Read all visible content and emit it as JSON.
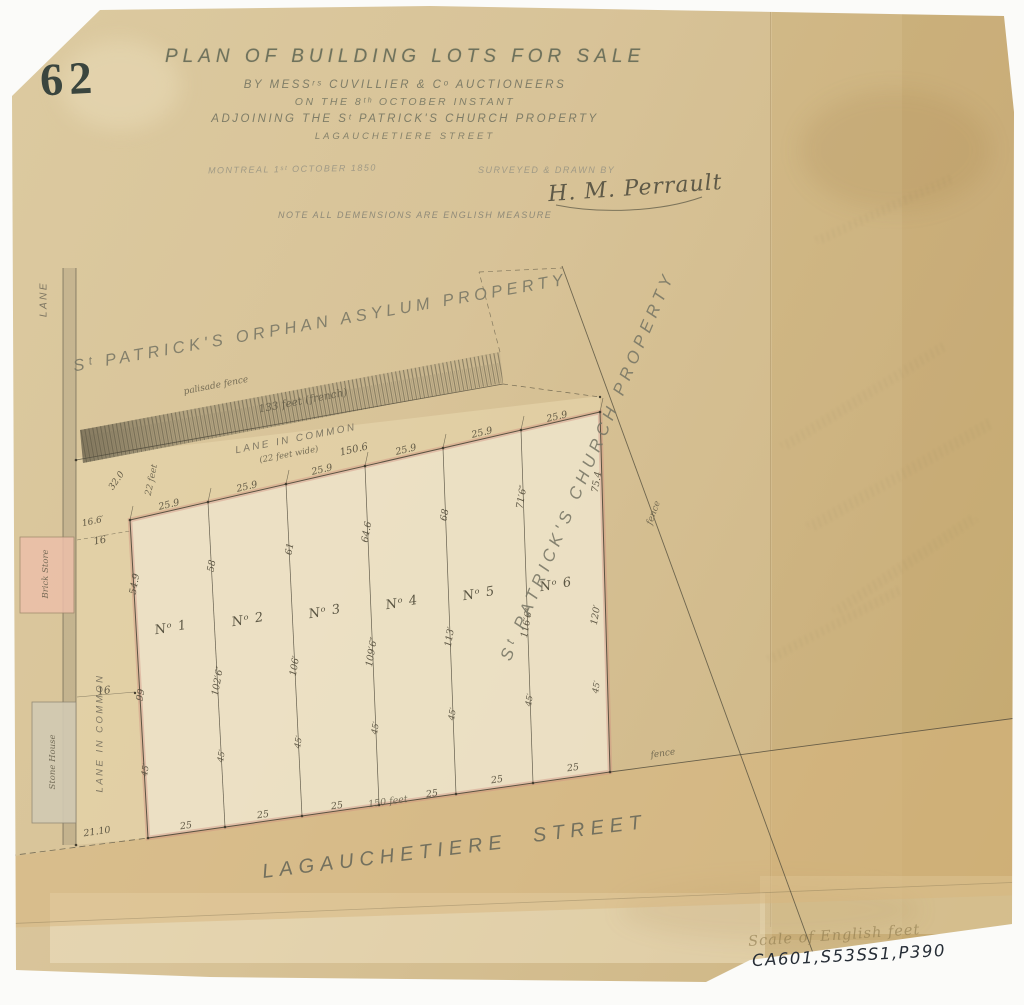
{
  "page_number": "62",
  "title_block": {
    "line1": "PLAN OF BUILDING LOTS FOR SALE",
    "line2": "BY MESSʳˢ CUVILLIER & Cᵒ AUCTIONEERS",
    "line3": "ON THE 8ᵗʰ OCTOBER INSTANT",
    "line4": "ADJOINING THE Sᵗ PATRICK'S CHURCH PROPERTY",
    "line5": "LAGAUCHETIERE STREET",
    "dateline": "MONTREAL 1ˢᵗ OCTOBER 1850",
    "surveyed_label": "SURVEYED & DRAWN BY",
    "signature": "H. M. Perrault",
    "note": "NOTE ALL DEMENSIONS ARE ENGLISH MEASURE"
  },
  "property_labels": {
    "asylum": "Sᵗ PATRICK'S ORPHAN ASYLUM PROPERTY",
    "church": "Sᵗ PATRICK'S CHURCH PROPERTY",
    "street_name": "LAGAUCHETIERE",
    "street_word": "STREET"
  },
  "archive": {
    "scale_note": "Scale of English feet",
    "reference": "CA601,S53SS1,P390"
  },
  "colors": {
    "paper": "#d6c195",
    "ink": "#4d4839",
    "faded_ink": "#7e8270",
    "boundary_pink": "#d08d7c",
    "lot_fill": "#eee4c9",
    "lane_fill": "#e7d7ae",
    "street_fill": "#d7b67e",
    "brick_fill": "#ecbfa9",
    "stone_fill": "#d2cab3"
  },
  "annotations": [
    {
      "t": "25.9",
      "x": 169,
      "y": 505,
      "r": -13,
      "n": "frontage-dim"
    },
    {
      "t": "25.9",
      "x": 247,
      "y": 487,
      "r": -13,
      "n": "frontage-dim"
    },
    {
      "t": "25.9",
      "x": 322,
      "y": 470,
      "r": -13,
      "n": "frontage-dim"
    },
    {
      "t": "150.6",
      "x": 354,
      "y": 450,
      "r": -13,
      "s": 10,
      "n": "total-top-dim"
    },
    {
      "t": "25.9",
      "x": 406,
      "y": 450,
      "r": -13,
      "n": "frontage-dim"
    },
    {
      "t": "25.9",
      "x": 482,
      "y": 433,
      "r": -13,
      "n": "frontage-dim"
    },
    {
      "t": "25.9",
      "x": 557,
      "y": 417,
      "r": -13,
      "n": "frontage-dim"
    },
    {
      "t": "palisade fence",
      "x": 216,
      "y": 386,
      "r": -11,
      "s": 9,
      "c": "script",
      "n": "palisade-fence-label"
    },
    {
      "t": "133 feet (french)",
      "x": 303,
      "y": 401,
      "r": -11,
      "s": 10.5,
      "c": "script",
      "n": "french-feet-label"
    },
    {
      "t": "LANE IN COMMON",
      "x": 296,
      "y": 439,
      "r": -11,
      "s": 10,
      "c": "caps",
      "n": "lane-in-common-label"
    },
    {
      "t": "(22 feet wide)",
      "x": 289,
      "y": 455,
      "r": -11,
      "s": 8.5,
      "c": "script",
      "n": "lane-width-label"
    },
    {
      "t": "LANE",
      "x": 44,
      "y": 299,
      "r": -90,
      "s": 10,
      "c": "caps",
      "n": "lane-label"
    },
    {
      "t": "22 feet",
      "x": 152,
      "y": 480,
      "r": -78,
      "s": 9,
      "c": "script",
      "n": "dim-label"
    },
    {
      "t": "32.0",
      "x": 117,
      "y": 481,
      "r": -55,
      "s": 9,
      "n": "dim-label"
    },
    {
      "t": "16.6′",
      "x": 93,
      "y": 522,
      "r": -12,
      "s": 9,
      "n": "dim-label"
    },
    {
      "t": "16",
      "x": 100,
      "y": 541,
      "r": -10,
      "s": 10,
      "n": "dim-label"
    },
    {
      "t": "16",
      "x": 104,
      "y": 691,
      "r": -8,
      "s": 10.5,
      "n": "dim-label"
    },
    {
      "t": "LANE IN COMMON",
      "x": 100,
      "y": 733,
      "r": -90,
      "s": 9.5,
      "c": "caps",
      "n": "lane-in-common-side-label"
    },
    {
      "t": "Brick Store",
      "x": 46,
      "y": 574,
      "r": -90,
      "s": 8.5,
      "c": "script",
      "n": "brick-store-label"
    },
    {
      "t": "Stone House",
      "x": 53,
      "y": 762,
      "r": -90,
      "s": 8.5,
      "c": "script",
      "n": "stone-house-label"
    },
    {
      "t": "54.9",
      "x": 135,
      "y": 584,
      "r": -80,
      "n": "depth-dim"
    },
    {
      "t": "58",
      "x": 212,
      "y": 566,
      "r": -80,
      "n": "depth-dim"
    },
    {
      "t": "61",
      "x": 290,
      "y": 549,
      "r": -80,
      "n": "depth-dim"
    },
    {
      "t": "64.6",
      "x": 367,
      "y": 532,
      "r": -80,
      "n": "depth-dim"
    },
    {
      "t": "68",
      "x": 445,
      "y": 515,
      "r": -80,
      "n": "depth-dim"
    },
    {
      "t": "71′6″",
      "x": 522,
      "y": 497,
      "r": -80,
      "n": "depth-dim"
    },
    {
      "t": "75.4",
      "x": 597,
      "y": 482,
      "r": -80,
      "n": "depth-dim"
    },
    {
      "t": "99",
      "x": 141,
      "y": 695,
      "r": -80,
      "n": "depth-dim"
    },
    {
      "t": "102′6″",
      "x": 218,
      "y": 681,
      "r": -80,
      "n": "depth-dim"
    },
    {
      "t": "106′",
      "x": 295,
      "y": 666,
      "r": -80,
      "n": "depth-dim"
    },
    {
      "t": "109′6″",
      "x": 372,
      "y": 652,
      "r": -80,
      "n": "depth-dim"
    },
    {
      "t": "113′",
      "x": 450,
      "y": 637,
      "r": -80,
      "n": "depth-dim"
    },
    {
      "t": "116′6″",
      "x": 527,
      "y": 623,
      "r": -80,
      "n": "depth-dim"
    },
    {
      "t": "120′",
      "x": 596,
      "y": 615,
      "r": -80,
      "n": "depth-dim"
    },
    {
      "t": "45′",
      "x": 146,
      "y": 770,
      "r": -80,
      "s": 8.5,
      "n": "depth-dim"
    },
    {
      "t": "45′",
      "x": 222,
      "y": 756,
      "r": -80,
      "s": 8.5,
      "n": "depth-dim"
    },
    {
      "t": "45′",
      "x": 299,
      "y": 742,
      "r": -80,
      "s": 8.5,
      "n": "depth-dim"
    },
    {
      "t": "45′",
      "x": 376,
      "y": 728,
      "r": -80,
      "s": 8.5,
      "n": "depth-dim"
    },
    {
      "t": "45′",
      "x": 453,
      "y": 714,
      "r": -80,
      "s": 8.5,
      "n": "depth-dim"
    },
    {
      "t": "45′",
      "x": 530,
      "y": 700,
      "r": -80,
      "s": 8.5,
      "n": "depth-dim"
    },
    {
      "t": "45′",
      "x": 597,
      "y": 687,
      "r": -80,
      "s": 8.5,
      "n": "depth-dim"
    },
    {
      "t": "Nᵒ 1",
      "x": 171,
      "y": 628,
      "r": -10,
      "s": 13,
      "c": "lot",
      "n": "lot-number-1"
    },
    {
      "t": "Nᵒ 2",
      "x": 248,
      "y": 620,
      "r": -10,
      "s": 13,
      "c": "lot",
      "n": "lot-number-2"
    },
    {
      "t": "Nᵒ 3",
      "x": 325,
      "y": 612,
      "r": -10,
      "s": 13,
      "c": "lot",
      "n": "lot-number-3"
    },
    {
      "t": "Nᵒ 4",
      "x": 402,
      "y": 603,
      "r": -10,
      "s": 13,
      "c": "lot",
      "n": "lot-number-4"
    },
    {
      "t": "Nᵒ 5",
      "x": 479,
      "y": 594,
      "r": -10,
      "s": 13,
      "c": "lot",
      "n": "lot-number-5"
    },
    {
      "t": "Nᵒ 6",
      "x": 556,
      "y": 585,
      "r": -10,
      "s": 13,
      "c": "lot",
      "n": "lot-number-6"
    },
    {
      "t": "25",
      "x": 186,
      "y": 826,
      "r": -8,
      "n": "street-frontage-dim"
    },
    {
      "t": "25",
      "x": 263,
      "y": 815,
      "r": -8,
      "n": "street-frontage-dim"
    },
    {
      "t": "25",
      "x": 337,
      "y": 806,
      "r": -8,
      "n": "street-frontage-dim"
    },
    {
      "t": "150 feet",
      "x": 388,
      "y": 802,
      "r": -8,
      "s": 9.5,
      "c": "script",
      "n": "total-bottom-dim"
    },
    {
      "t": "25",
      "x": 432,
      "y": 794,
      "r": -8,
      "n": "street-frontage-dim"
    },
    {
      "t": "25",
      "x": 497,
      "y": 780,
      "r": -8,
      "n": "street-frontage-dim"
    },
    {
      "t": "25",
      "x": 573,
      "y": 768,
      "r": -8,
      "n": "street-frontage-dim"
    },
    {
      "t": "21.10",
      "x": 97,
      "y": 832,
      "r": -8,
      "s": 9.5,
      "n": "offset-dim"
    },
    {
      "t": "fence",
      "x": 654,
      "y": 513,
      "r": -70,
      "s": 9,
      "c": "script",
      "n": "fence-label"
    },
    {
      "t": "fence",
      "x": 663,
      "y": 754,
      "r": -8,
      "s": 9,
      "c": "script",
      "n": "fence-label"
    }
  ]
}
